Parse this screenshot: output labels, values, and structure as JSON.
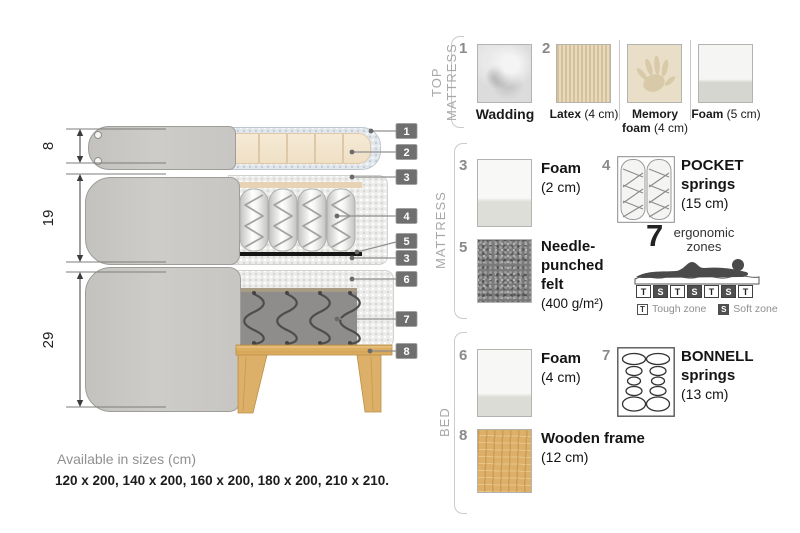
{
  "diagram": {
    "dims": {
      "top_mattress": "8",
      "mattress": "19",
      "bed": "29"
    },
    "callouts": [
      {
        "n": "1"
      },
      {
        "n": "2"
      },
      {
        "n": "3"
      },
      {
        "n": "4"
      },
      {
        "n": "5"
      },
      {
        "n": "3"
      },
      {
        "n": "6"
      },
      {
        "n": "7"
      },
      {
        "n": "8"
      }
    ]
  },
  "legend": {
    "sections": {
      "top": "TOP MATTRESS",
      "mid": "MATTRESS",
      "bed": "BED"
    },
    "wadding": {
      "num": "1",
      "name": "Wadding"
    },
    "latex": {
      "num": "2",
      "name": "Latex",
      "size": "(4 cm)"
    },
    "memory": {
      "name_line1": "Memory",
      "name_line2": "foam",
      "size": "(4 cm)"
    },
    "foam5": {
      "name": "Foam",
      "size": "(5 cm)"
    },
    "foam2": {
      "num": "3",
      "name": "Foam",
      "size": "(2 cm)"
    },
    "pocket": {
      "num": "4",
      "name_line1": "POCKET",
      "name_line2": "springs",
      "size": "(15 cm)"
    },
    "felt": {
      "num": "5",
      "name": "Needle-punched felt",
      "size": "(400 g/m²)"
    },
    "zones": {
      "count": "7",
      "label_line1": "ergonomic",
      "label_line2": "zones",
      "letters": [
        "T",
        "S",
        "T",
        "S",
        "T",
        "S",
        "T"
      ],
      "tough_key": "T",
      "tough_label": "Tough zone",
      "soft_key": "S",
      "soft_label": "Soft zone"
    },
    "foam4": {
      "num": "6",
      "name": "Foam",
      "size": "(4 cm)"
    },
    "bonnell": {
      "num": "7",
      "name_line1": "BONNELL",
      "name_line2": "springs",
      "size": "(13 cm)"
    },
    "wood": {
      "num": "8",
      "name": "Wooden frame",
      "size": "(12 cm)"
    }
  },
  "sizes": {
    "title": "Available in sizes (cm)",
    "list": "120 x 200, 140 x 200, 160 x 200, 180 x 200, 210 x 210."
  },
  "colors": {
    "fabric_grey": "#cac9c5",
    "wadding_blue": "#e2e7ec",
    "latex_beige": "#f3e6cf",
    "bonnell_grey": "#8e8d8b",
    "felt_black": "#161616",
    "wood": "#ddb069",
    "callout_box": "#6f6f6f",
    "section_label_grey": "#a8a8a8"
  }
}
